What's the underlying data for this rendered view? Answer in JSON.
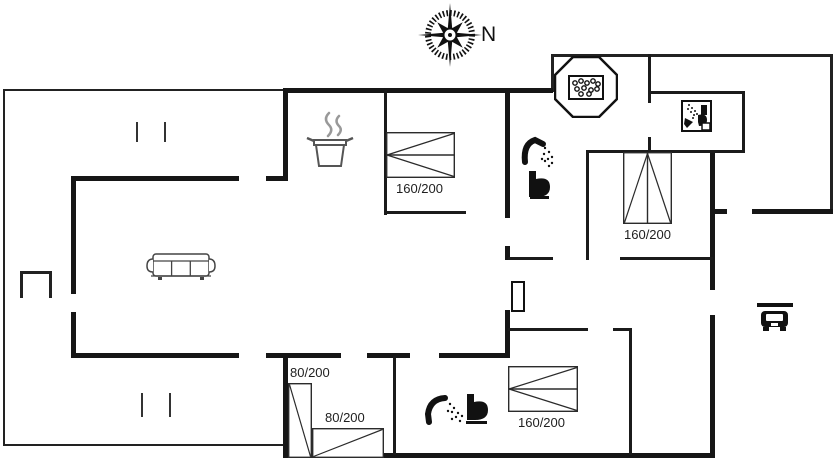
{
  "page": {
    "type": "holiday-house floor plan drawing",
    "background": "#ffffff"
  },
  "compass": {
    "north_label": "N"
  },
  "beds": [
    {
      "name": "double-bed-north",
      "type": "double",
      "size_label": "160/200"
    },
    {
      "name": "double-bed-east",
      "type": "double",
      "size_label": "160/200"
    },
    {
      "name": "single-bed-west-upper",
      "type": "single",
      "size_label": "80/200"
    },
    {
      "name": "single-bed-west-lower",
      "type": "single",
      "size_label": "80/200"
    },
    {
      "name": "double-bed-south",
      "type": "double",
      "size_label": "160/200"
    }
  ],
  "icons": {
    "compass": "compass-rose",
    "hot_tub": "octagonal-hot-tub",
    "bath_north": "shower-and-toilet",
    "bath_south": "shower-and-toilet",
    "bath_box": "boxed-shower-toilet",
    "kitchen": "cooking-pot-with-steam",
    "living": "sofa",
    "carport": "car-under-roof",
    "entrance": "door-leaf",
    "terrace_table": "side-table"
  },
  "colors": {
    "wall": "#161616",
    "interior_wall": "#1b1b1b",
    "thin_wall": "#222222",
    "line": "#2b2b2b",
    "steam": "#999999",
    "label_text": "#1f1f1f"
  }
}
